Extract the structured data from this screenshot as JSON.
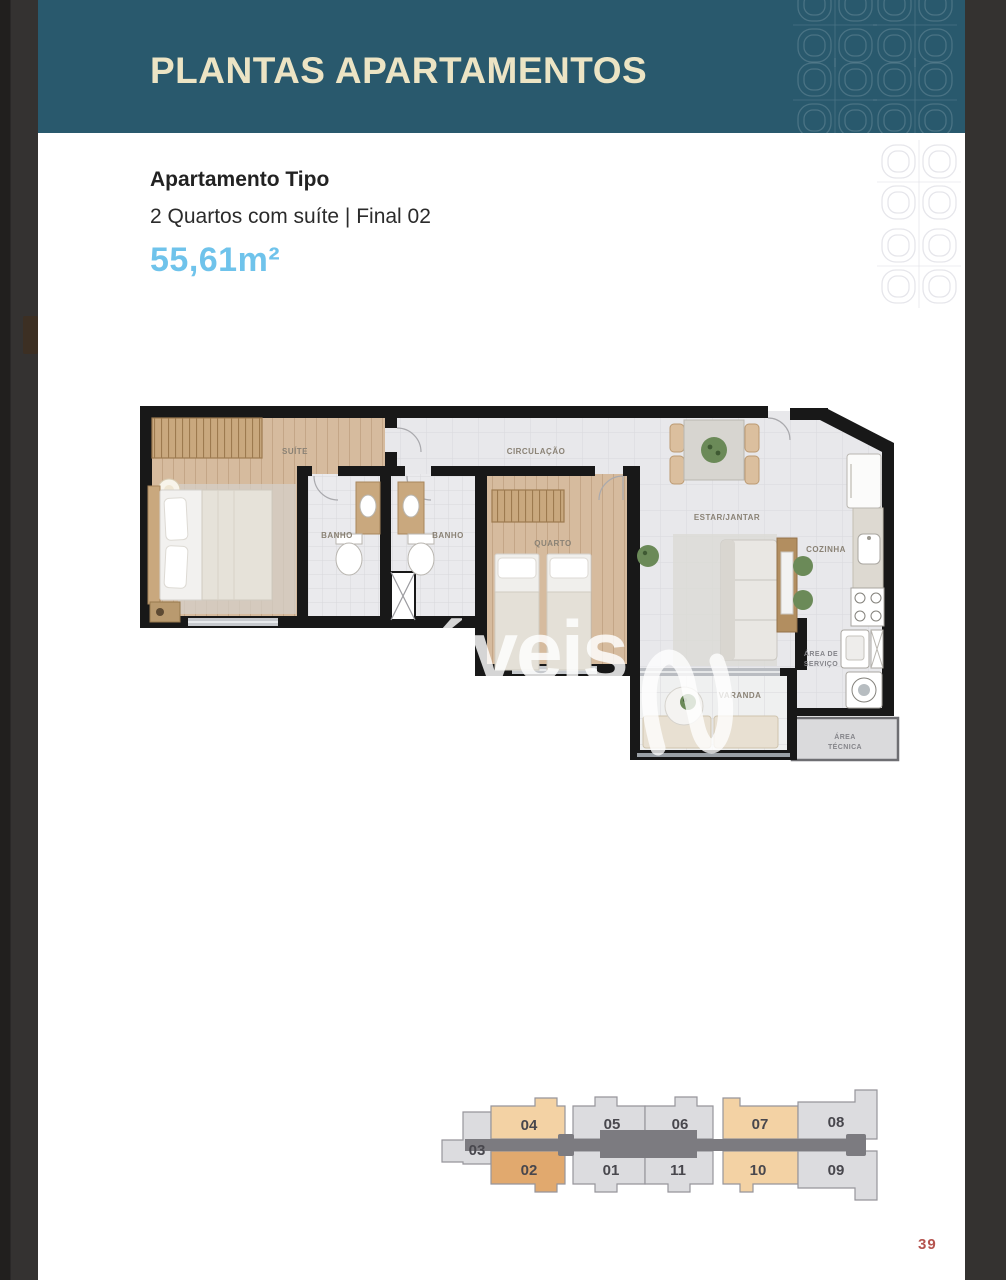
{
  "header": {
    "title": "PLANTAS APARTAMENTOS"
  },
  "apartment": {
    "type_label": "Apartamento Tipo",
    "description": "2 Quartos com suíte | Final 02",
    "area": "55,61m²"
  },
  "floor_plan": {
    "watermark": "óveis",
    "rooms": {
      "suite": "SUÍTE",
      "banho1": "BANHO",
      "banho2": "BANHO",
      "circulacao": "CIRCULAÇÃO",
      "quarto": "QUARTO",
      "estar_jantar": "ESTAR/JANTAR",
      "cozinha": "COZINHA",
      "area_servico_l1": "ÁREA DE",
      "area_servico_l2": "SERVIÇO",
      "varanda": "VARANDA",
      "area_tecnica_l1": "ÁREA",
      "area_tecnica_l2": "TÉCNICA"
    }
  },
  "key_plan": {
    "highlighted_unit": "02",
    "units": [
      {
        "label": "03"
      },
      {
        "label": "04"
      },
      {
        "label": "05"
      },
      {
        "label": "06"
      },
      {
        "label": "07"
      },
      {
        "label": "08"
      },
      {
        "label": "02"
      },
      {
        "label": "01"
      },
      {
        "label": "11"
      },
      {
        "label": "10"
      },
      {
        "label": "09"
      }
    ]
  },
  "page": {
    "number": "39"
  },
  "colors": {
    "header_bg": "#29596d",
    "header_text": "#ece4c4",
    "area_text": "#6fc3eb",
    "page_number": "#b5534e",
    "unit_highlight": "#e1a96e",
    "unit_peach": "#f3d2a4",
    "unit_gray": "#dcdcdf",
    "corridor": "#7c7b80"
  }
}
